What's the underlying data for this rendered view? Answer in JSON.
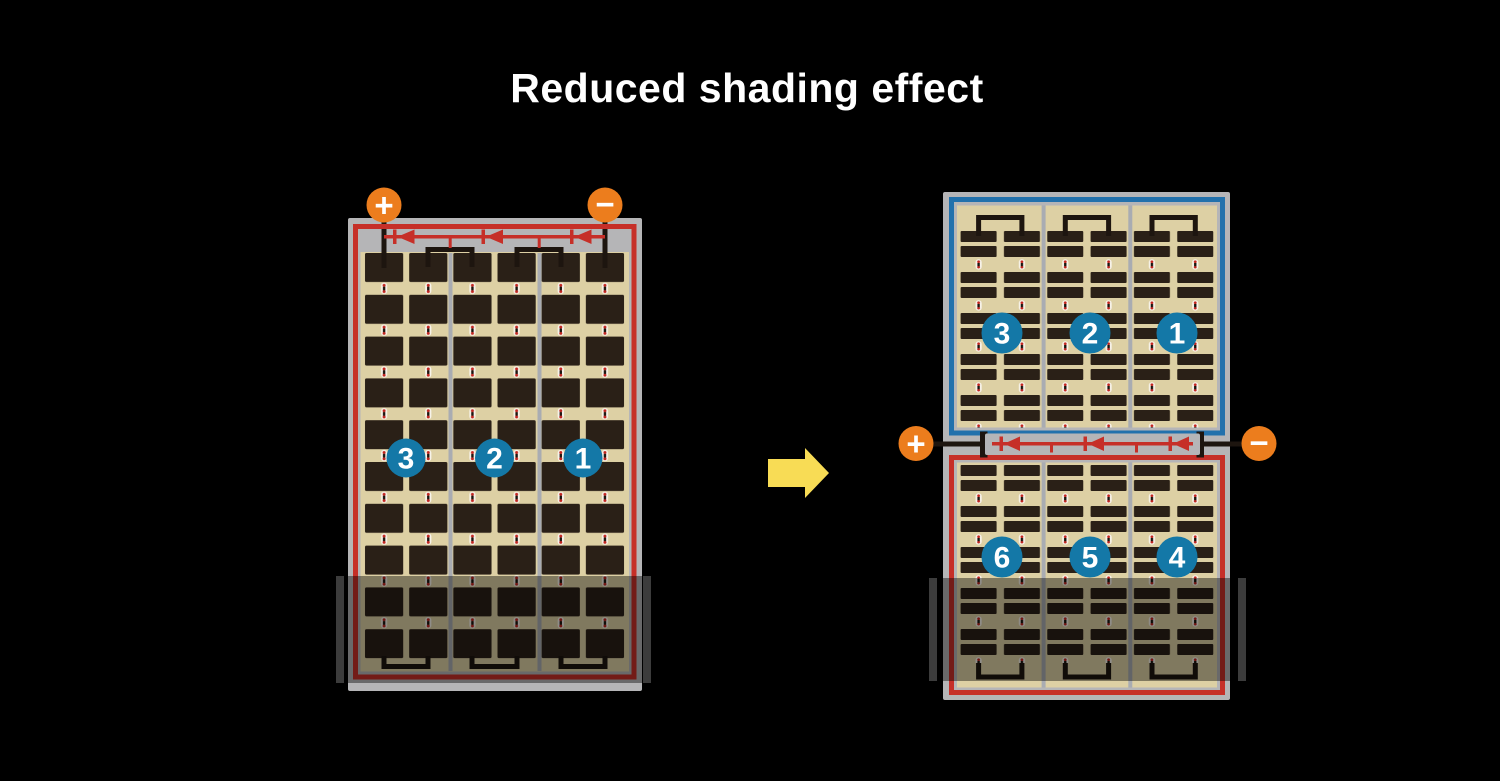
{
  "title": "Reduced shading effect",
  "colors": {
    "background": "#000000",
    "panel_frame_gray": "#b5b5b7",
    "cell_field_tan": "#ddd0a4",
    "cell_dark": "#2a2017",
    "string_border_red": "#c62f28",
    "string_border_blue": "#2271ac",
    "number_circle_blue": "#1478a7",
    "terminal_orange": "#ec7d1d",
    "arrow_yellow": "#f8dc55",
    "divider_gray": "#a9acb2",
    "shade_overlay": "rgba(0,0,0,0.42)"
  },
  "left_module": {
    "terminal_plus": "+",
    "terminal_minus": "−",
    "strings": [
      {
        "number": "3"
      },
      {
        "number": "2"
      },
      {
        "number": "1"
      }
    ],
    "bypass_diodes": 3,
    "cell_columns": 6,
    "cell_rows": 10,
    "shaded_bottom_rows": 2
  },
  "right_module": {
    "terminal_plus": "+",
    "terminal_minus": "−",
    "top_strings": [
      {
        "number": "3"
      },
      {
        "number": "2"
      },
      {
        "number": "1"
      }
    ],
    "bottom_strings": [
      {
        "number": "6"
      },
      {
        "number": "5"
      },
      {
        "number": "4"
      }
    ],
    "bypass_diodes": 3
  }
}
